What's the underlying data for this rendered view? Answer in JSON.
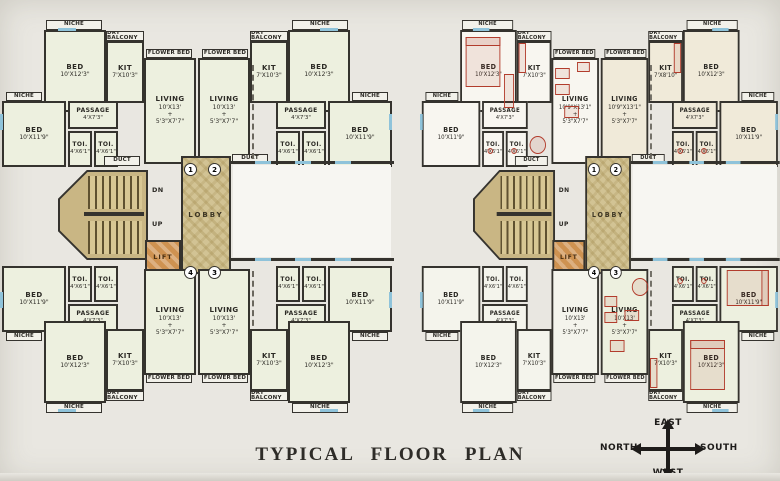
{
  "title": "TYPICAL FLOOR PLAN",
  "compass": {
    "top": "EAST",
    "left": "NORTH",
    "right": "SOUTH",
    "bottom": "WEST"
  },
  "rooms": {
    "bed_a": {
      "name": "BED",
      "dims": "10'X12'3\""
    },
    "bed_b": {
      "name": "BED",
      "dims": "10'X11'9\""
    },
    "kit": {
      "name": "KIT",
      "dims": "7'X10'3\""
    },
    "kit_small": {
      "name": "KIT",
      "dims": "7'X8'10\""
    },
    "living": {
      "name": "LIVING",
      "dims": "10'X13'\n+\n5'3\"X7'7\""
    },
    "living_alt": {
      "name": "LIVING",
      "dims": "10'9\"X13'1\"\n+\n5'3\"X7'7\""
    },
    "passage": {
      "name": "PASSAGE",
      "dims": "4'X7'3\""
    },
    "toi": {
      "name": "TOI.",
      "dims": "4'X6'1\""
    },
    "lobby": "LOBBY",
    "lift": "LIFT",
    "duct": "DUCT",
    "dn": "DN",
    "up": "UP",
    "niche": "NICHE",
    "dry_balcony": "DRY BALCONY",
    "flower_bed": "FLOWER BED"
  },
  "door_numbers": {
    "one": "1",
    "two": "2",
    "three": "3",
    "four": "4"
  },
  "colors": {
    "wall": "#35332e",
    "pale_green_room": "#edf0df",
    "white_room": "#f8f6f0",
    "cream_room": "#f0ead9",
    "lobby_tan": "#d2c394",
    "lift_orange": "#ce9251",
    "stair_tan": "#c9b684",
    "furniture_red": "#b23c2c",
    "window_blue": "#8fc3da",
    "background": "#e9e7e1"
  }
}
